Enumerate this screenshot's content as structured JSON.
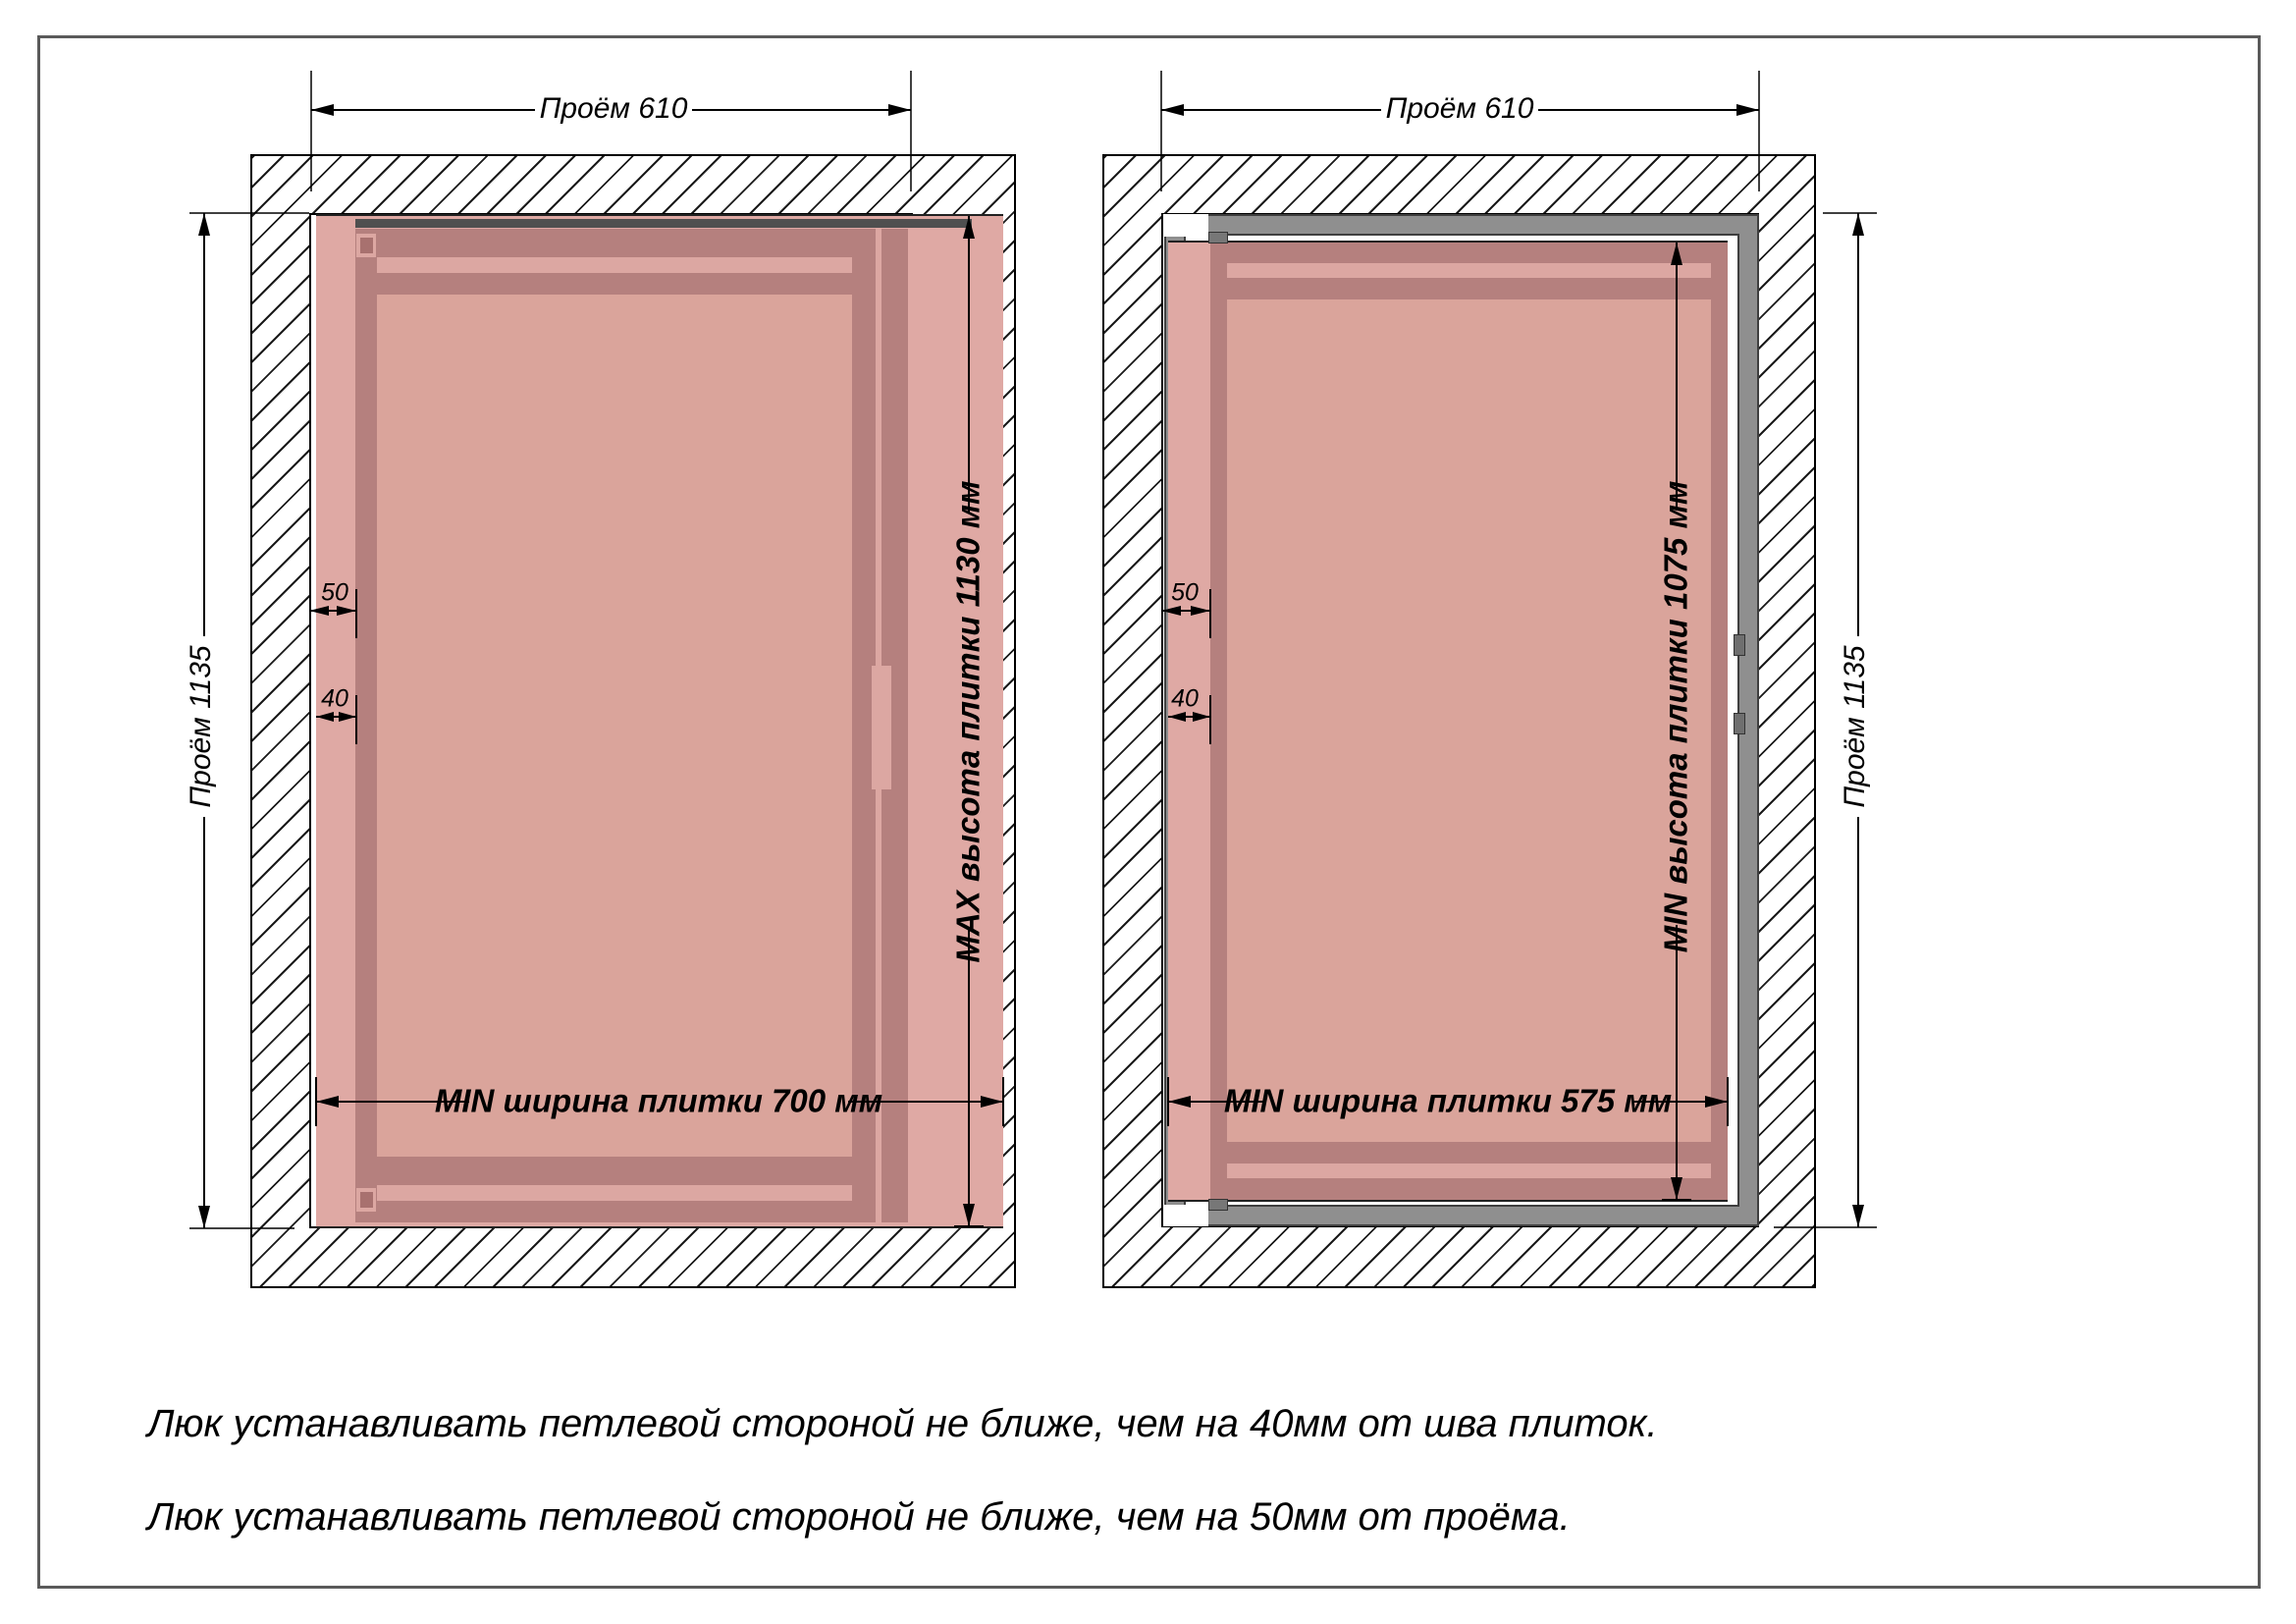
{
  "diagrams": {
    "left": {
      "opening_width_label": "Проём 610",
      "opening_height_label": "Проём 1135",
      "hinge_offset_label": "50",
      "seam_offset_label": "40",
      "tile_width_label": "MIN ширина плитки 700 мм",
      "tile_height_label": "MAX высота плитки 1130 мм"
    },
    "right": {
      "opening_width_label": "Проём 610",
      "opening_height_label": "Проём 1135",
      "hinge_offset_label": "50",
      "seam_offset_label": "40",
      "tile_width_label": "MIN ширина плитки 575 мм",
      "tile_height_label": "MIN высота плитки 1075 мм"
    }
  },
  "notes": [
    "Люк устанавливать петлевой стороной не ближе, чем на 40мм от шва плиток.",
    "Люк устанавливать петлевой стороной не ближе, чем на 50мм от проёма."
  ],
  "colors": {
    "tile_pink": "#DFA9A4",
    "frame_dark_mauve": "#B5807E",
    "door_face_pink": "#DAA49B",
    "ring_light_pink": "#DCA7A2",
    "steel_gray": "#8F8F8F",
    "hatch_line": "#1a1a1a",
    "dimension_black": "#000000",
    "page_border_gray": "#5a5a5a"
  }
}
